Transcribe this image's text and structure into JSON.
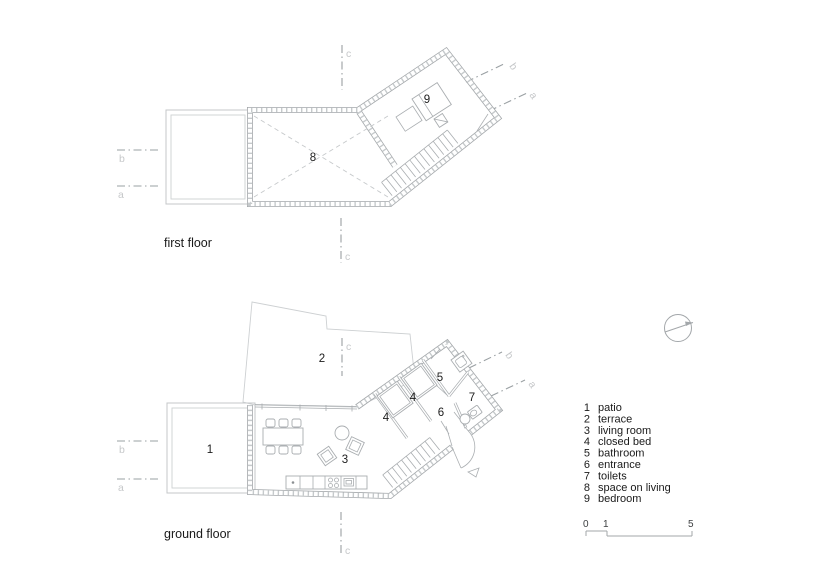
{
  "first_floor": {
    "label": "first floor",
    "rooms": {
      "space_on_living": "8",
      "bedroom": "9"
    },
    "sections": {
      "c_top": "c",
      "c_bottom": "c",
      "b_left": "b",
      "a_left": "a",
      "b_right": "b",
      "a_right": "a"
    }
  },
  "ground_floor": {
    "label": "ground floor",
    "rooms": {
      "patio": "1",
      "terrace": "2",
      "living_room": "3",
      "closed_bed_1": "4",
      "closed_bed_2": "4",
      "bathroom": "5",
      "entrance": "6",
      "toilets": "7"
    },
    "sections": {
      "c_top": "c",
      "c_bottom": "c",
      "b_left": "b",
      "a_left": "a",
      "b_right": "b",
      "a_right": "a"
    }
  },
  "legend": {
    "items": [
      {
        "num": "1",
        "label": "patio"
      },
      {
        "num": "2",
        "label": "terrace"
      },
      {
        "num": "3",
        "label": "living room"
      },
      {
        "num": "4",
        "label": "closed bed"
      },
      {
        "num": "5",
        "label": "bathroom"
      },
      {
        "num": "6",
        "label": "entrance"
      },
      {
        "num": "7",
        "label": "toilets"
      },
      {
        "num": "8",
        "label": "space on living"
      },
      {
        "num": "9",
        "label": "bedroom"
      }
    ]
  },
  "scale_bar": {
    "ticks": [
      "0",
      "1",
      "5"
    ]
  },
  "north_indicator": {
    "icon": "north-indicator-icon"
  },
  "colors": {
    "wall_line": "#a3a7aa",
    "thin_line": "#a9adb0",
    "ghost_line": "#cdd0d2",
    "section_line": "#9aa0a3",
    "section_label": "#c6c8ca",
    "text": "#1a1a1a"
  }
}
